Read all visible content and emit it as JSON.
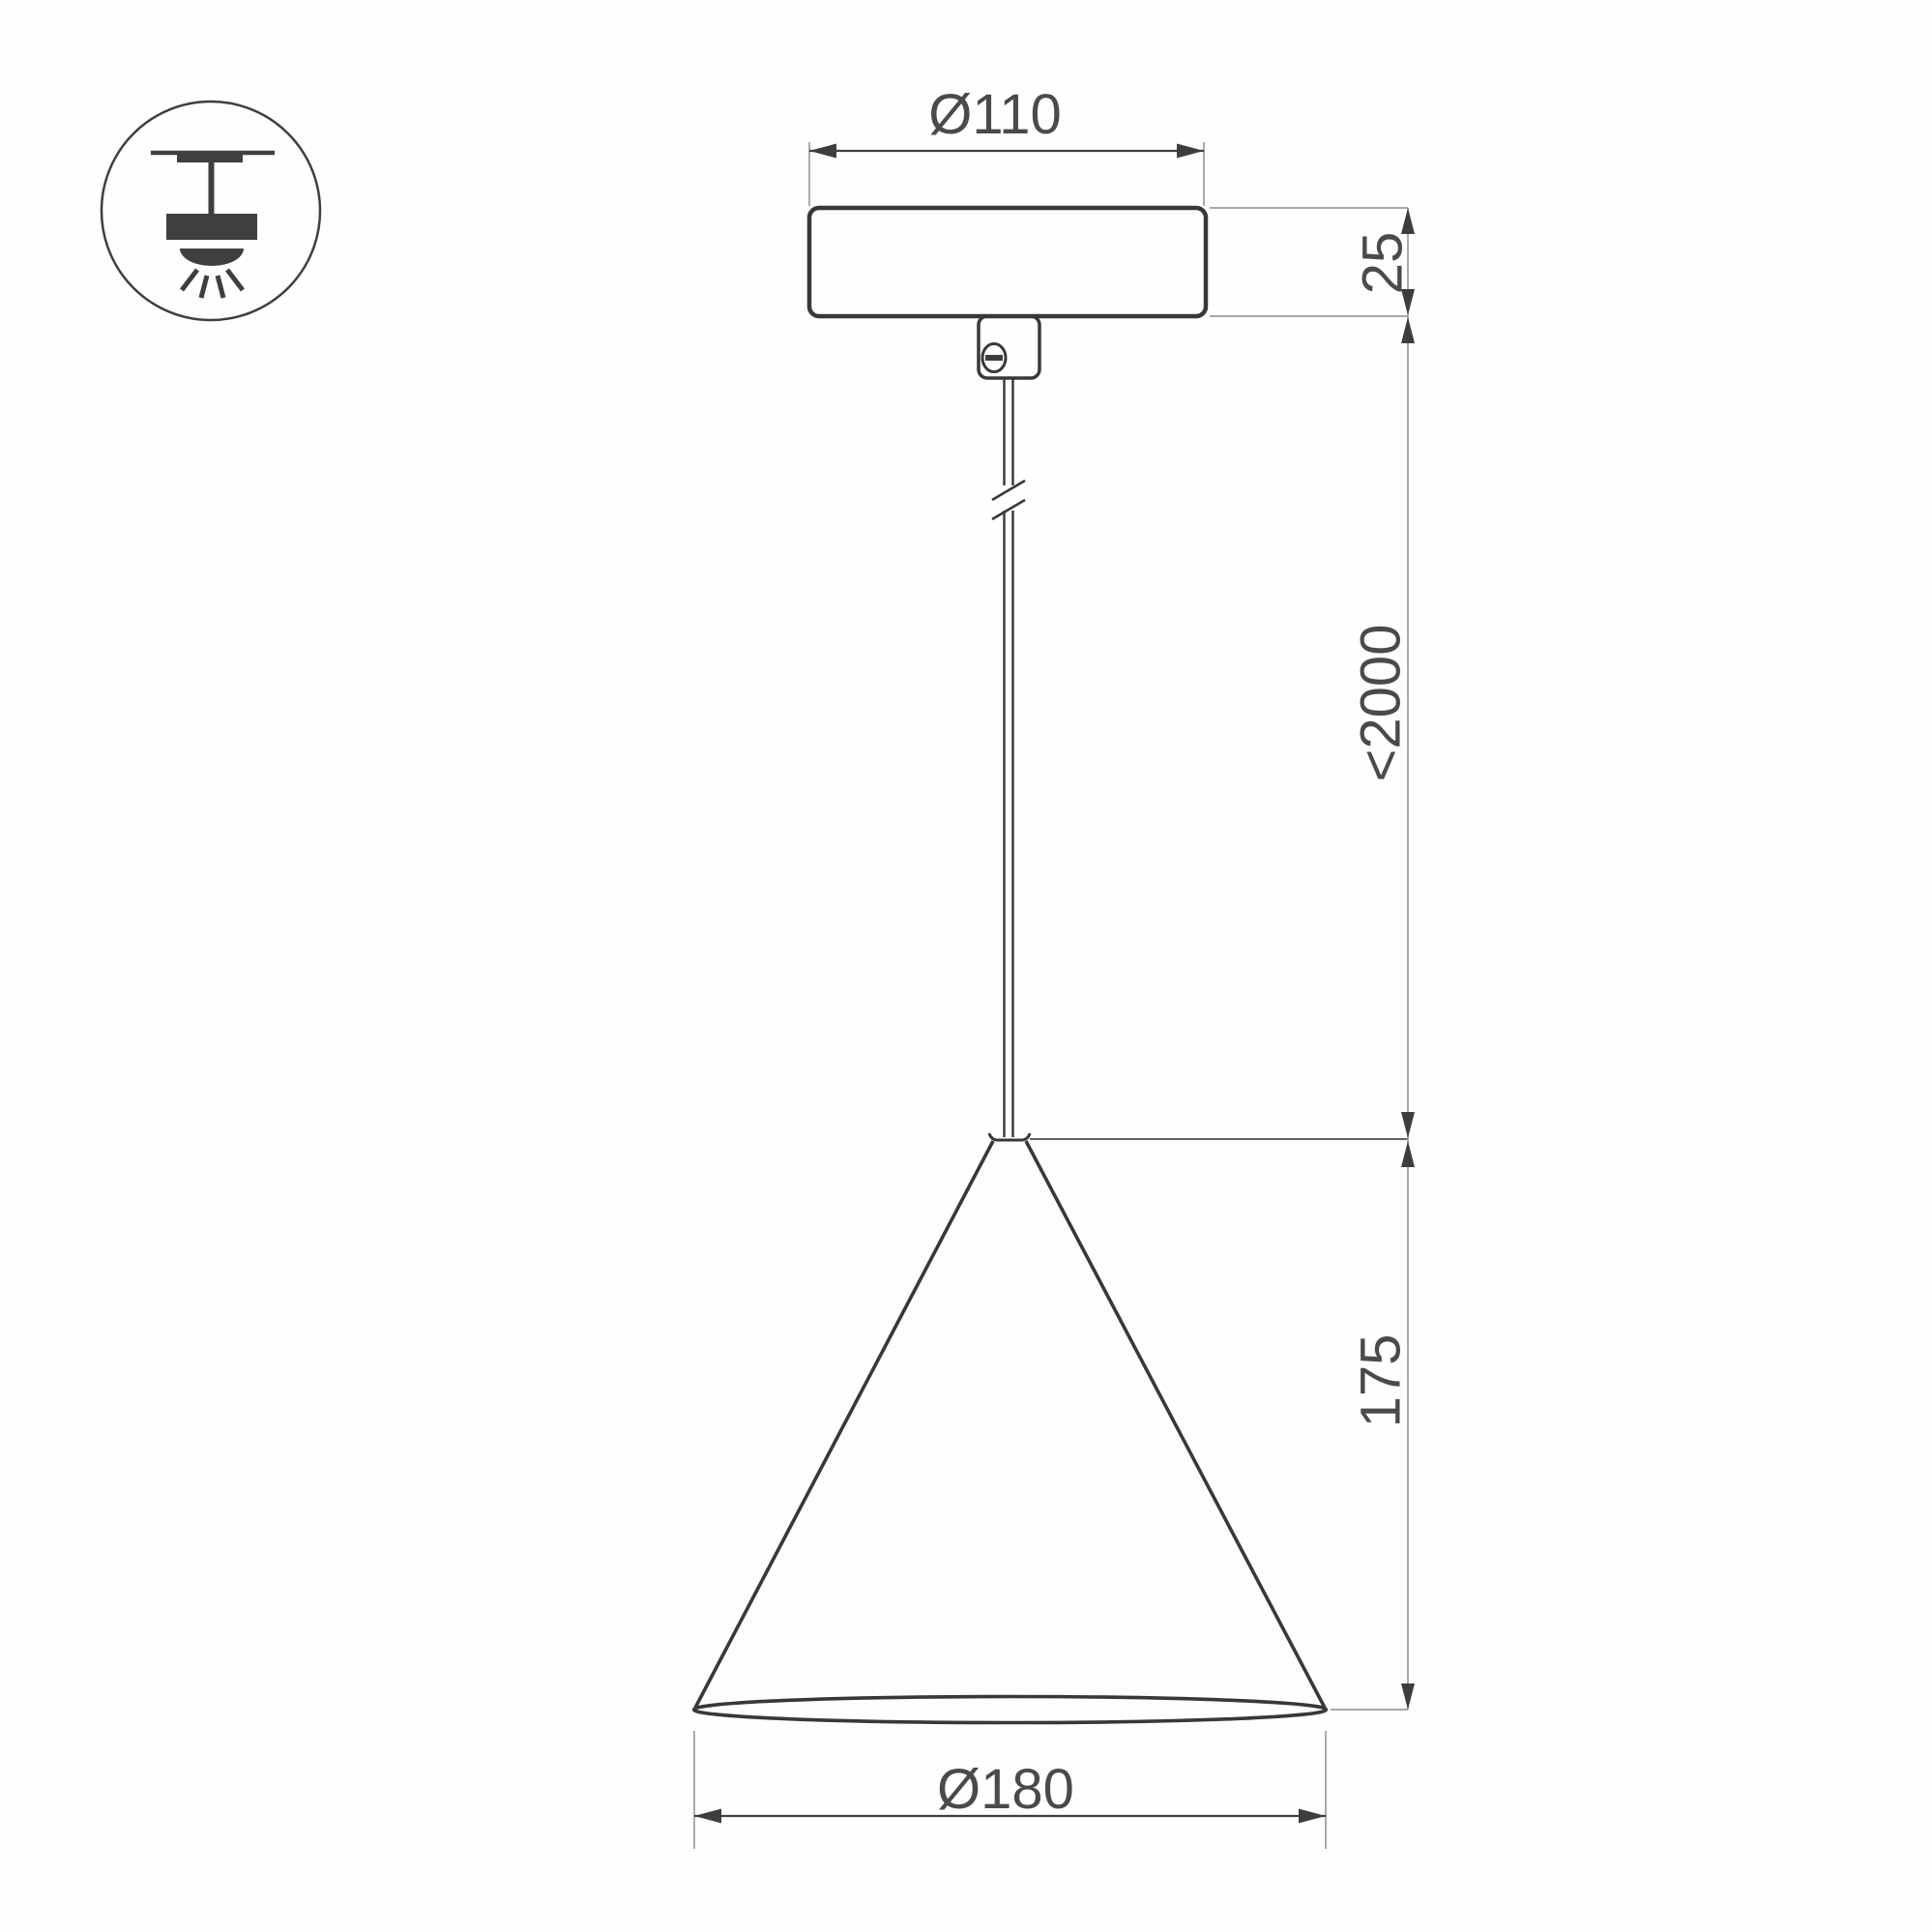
{
  "title": "Cone pendant luminaire dimension drawing",
  "icon": {
    "name": "pendant-ceiling-mount",
    "description": "surface ceiling mounted pendant light symbol"
  },
  "dimensions": {
    "canopy_diameter": "Ø110",
    "canopy_height": "25",
    "suspension_length": "<2000",
    "shade_height": "175",
    "shade_diameter": "Ø180"
  },
  "units": "mm",
  "colors": {
    "background": "#fefefe",
    "object_line": "#383838",
    "extension_line": "#9c9c9c",
    "arrow": "#3d3d3d",
    "text": "#4a4a4a"
  }
}
